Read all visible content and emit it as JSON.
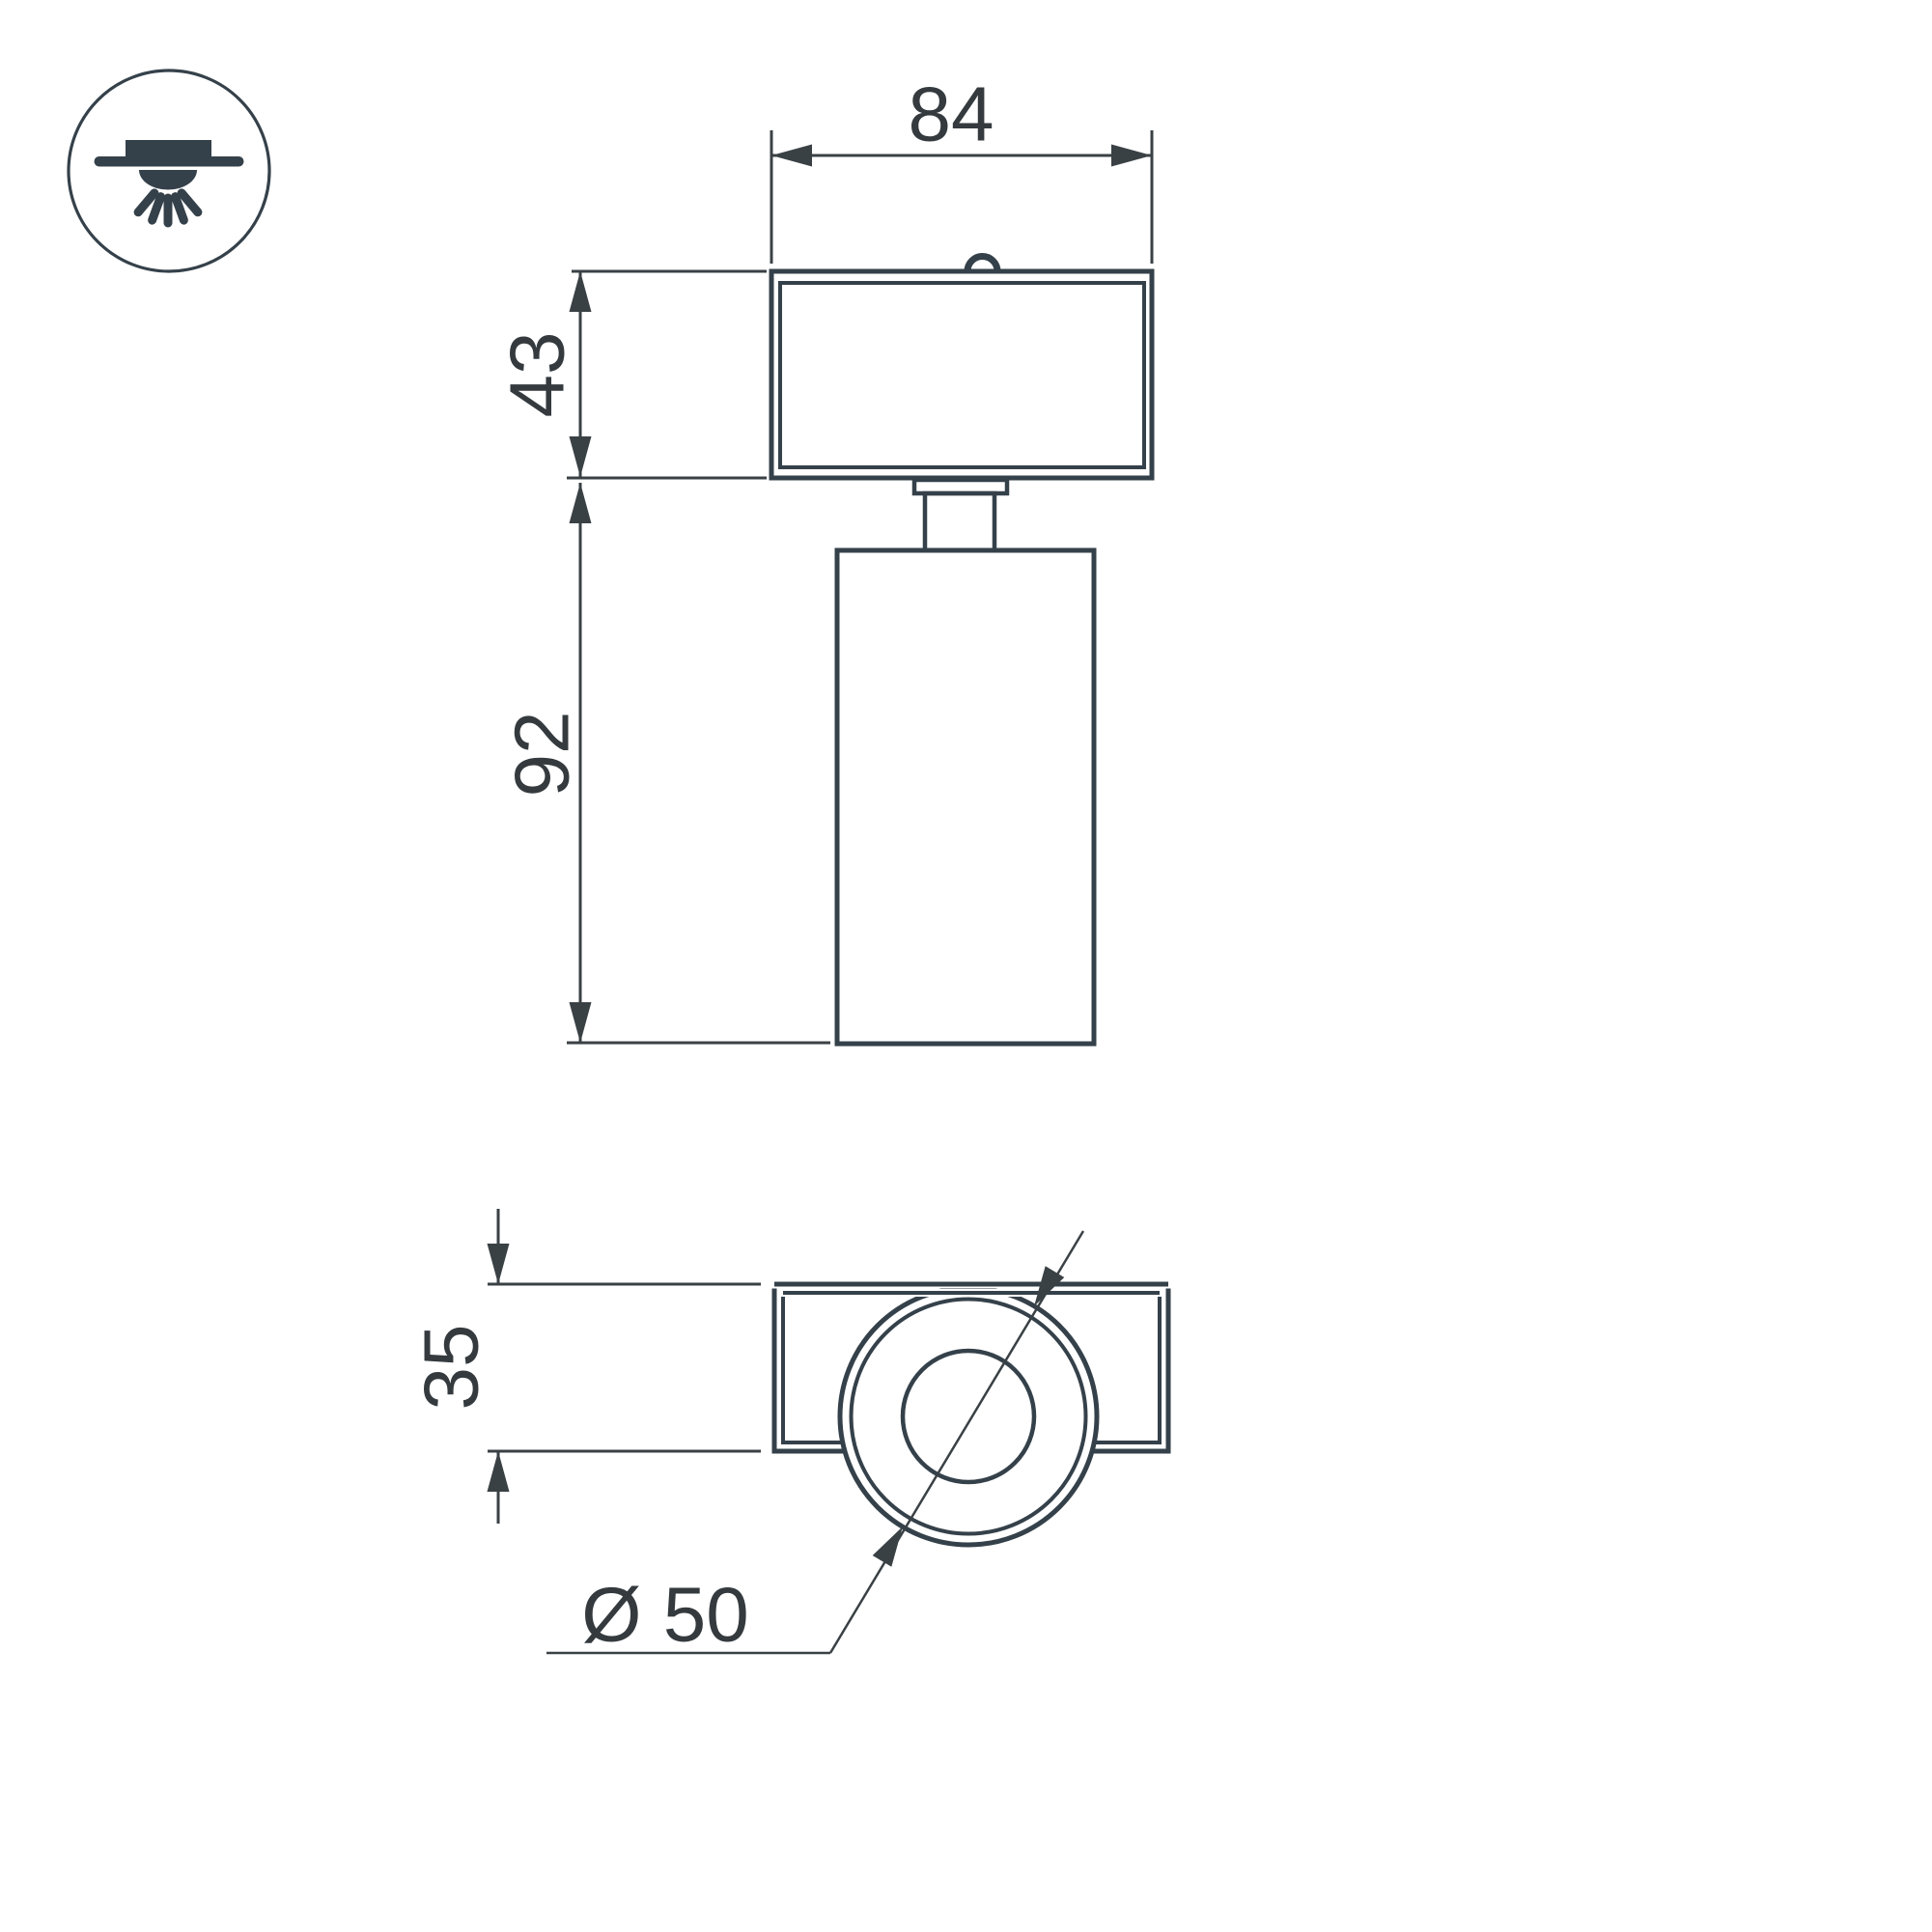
{
  "drawing": {
    "background": "#ffffff",
    "line_color": "#35414a",
    "dim_line_color": "#3a4145",
    "text_color": "#343a3e"
  },
  "icon": {
    "name": "recessed-downlight-icon"
  },
  "front_view": {
    "width_label": "84",
    "base_height_label": "43",
    "body_height_label": "92"
  },
  "bottom_view": {
    "base_depth_label": "35",
    "diameter_label": "Ø 50"
  }
}
